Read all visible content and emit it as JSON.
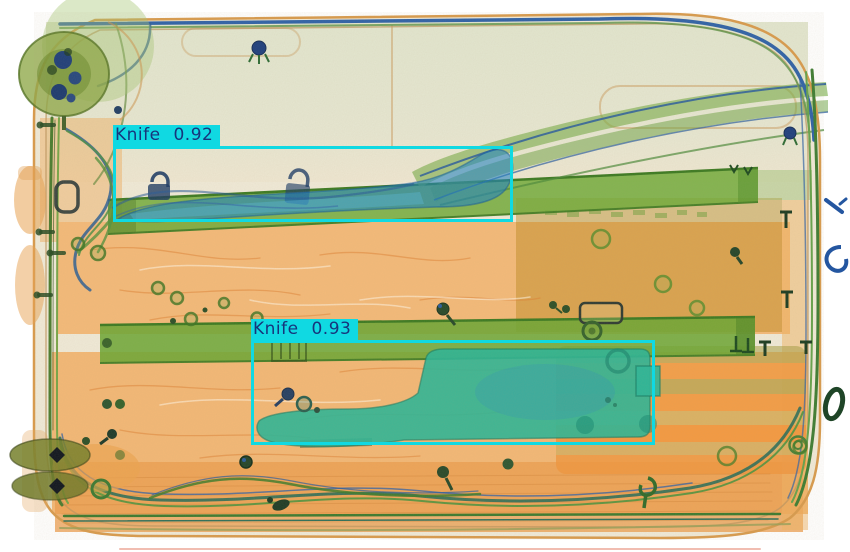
{
  "detections": [
    {
      "label": "Knife",
      "score": 0.92,
      "text": "Knife 0.92",
      "box": {
        "x": 113,
        "y": 146,
        "width": 400,
        "height": 76
      }
    },
    {
      "label": "Knife",
      "score": 0.93,
      "text": "Knife 0.93",
      "box": {
        "x": 251,
        "y": 340,
        "width": 404,
        "height": 105
      }
    }
  ],
  "style": {
    "box_color": "#10d9e2",
    "label_bg": "#10d9e2",
    "label_text_color": "#17357c"
  },
  "scene": {
    "type": "xray-baggage-scan",
    "objects": [
      "suitcase",
      "knife",
      "cleaver",
      "handle-rails",
      "wheels",
      "screws",
      "padlocks"
    ]
  }
}
